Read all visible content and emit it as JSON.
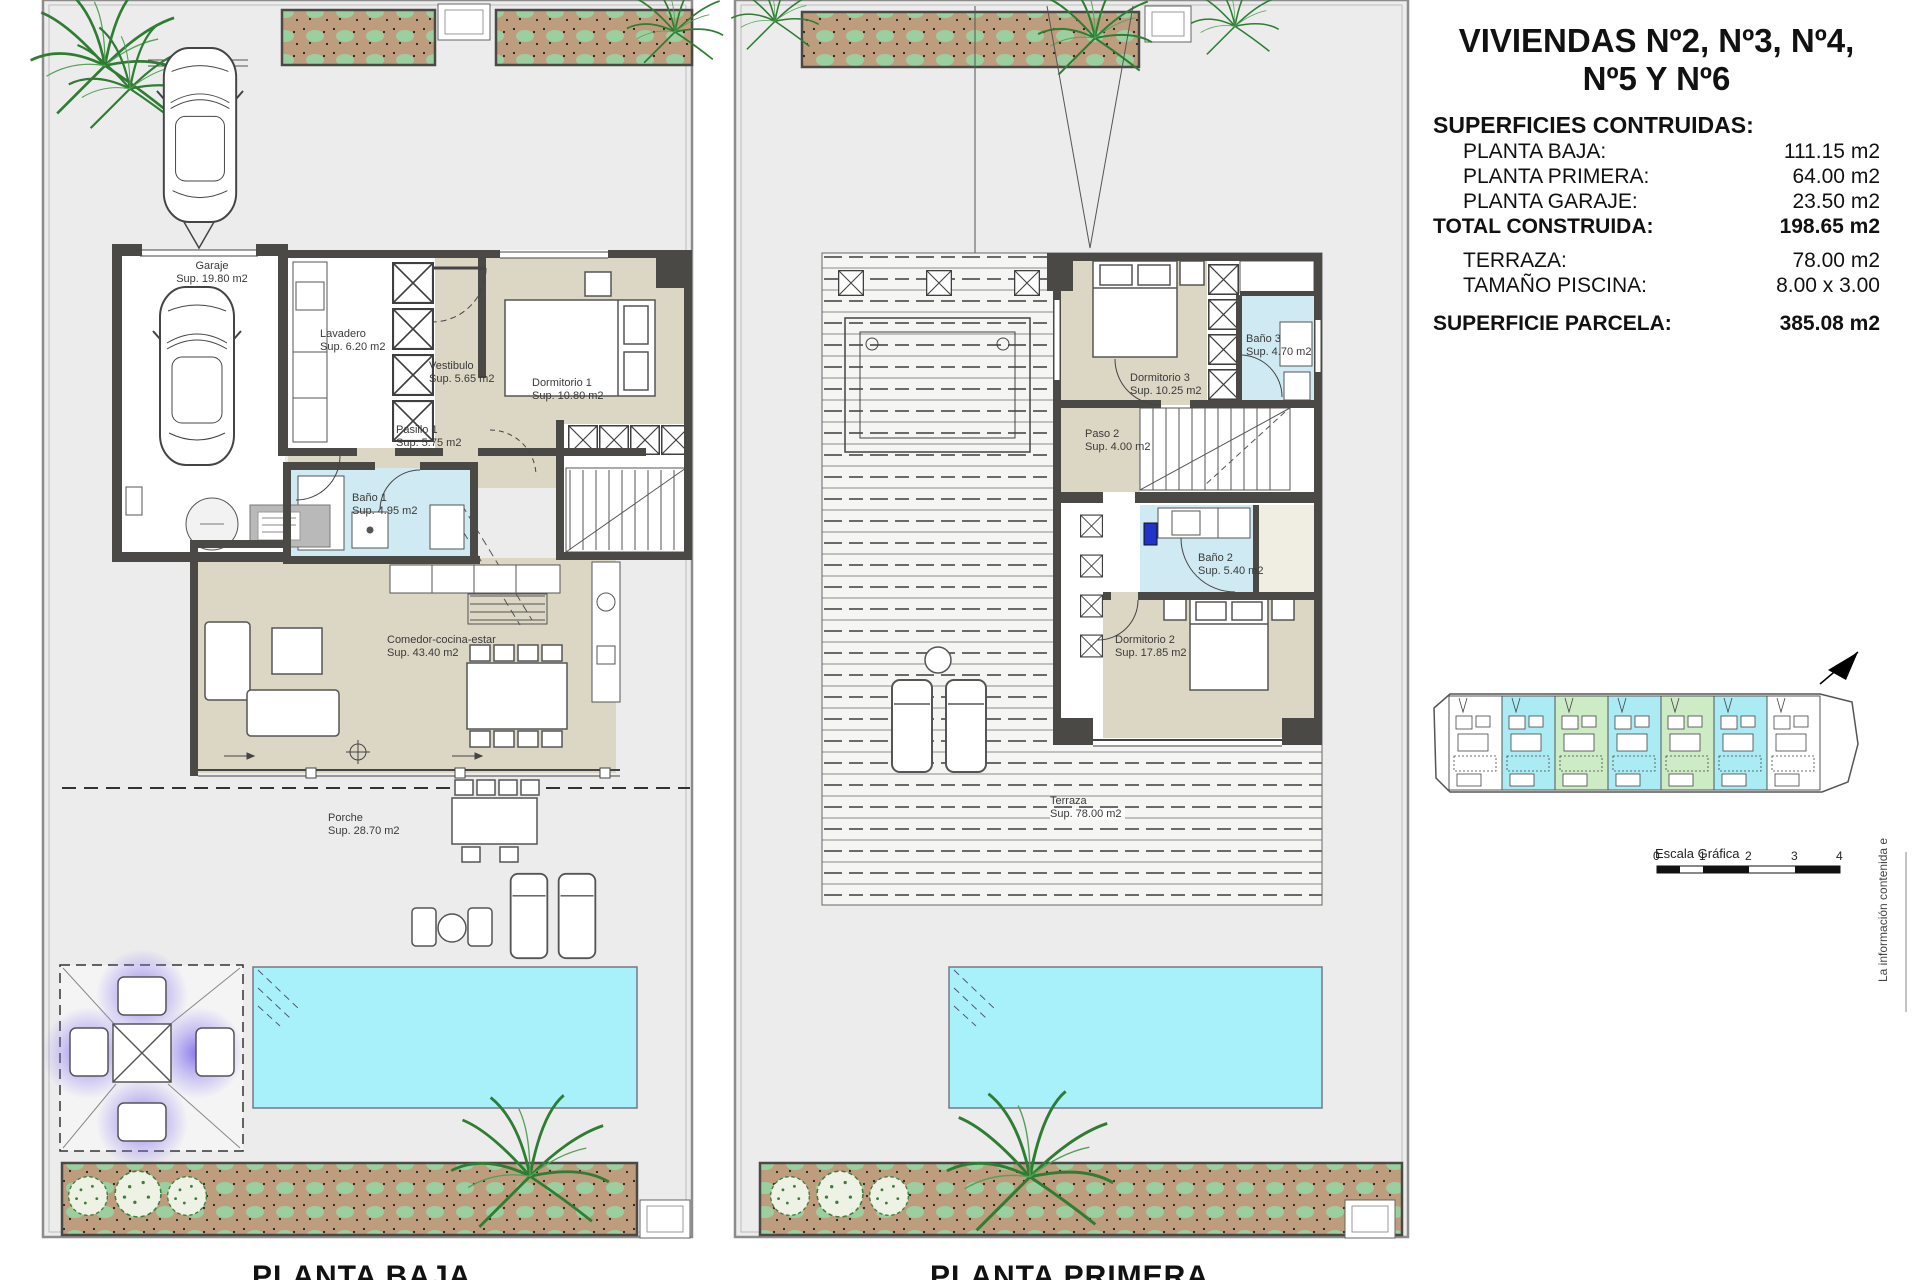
{
  "sheet": {
    "title_line1": "VIVIENDAS Nº2, Nº3, Nº4,",
    "title_line2": "Nº5 Y Nº6",
    "surfaces_heading": "SUPERFICIES CONTRUIDAS:",
    "rows": [
      {
        "label": "PLANTA BAJA:",
        "value": "111.15 m2"
      },
      {
        "label": "PLANTA PRIMERA:",
        "value": "64.00 m2"
      },
      {
        "label": "PLANTA GARAJE:",
        "value": "23.50 m2"
      },
      {
        "label": "TOTAL CONSTRUIDA:",
        "value": "198.65 m2"
      },
      {
        "label": "TERRAZA:",
        "value": "78.00 m2"
      },
      {
        "label": "TAMAÑO PISCINA:",
        "value": "8.00 x 3.00"
      },
      {
        "label": "SUPERFICIE PARCELA:",
        "value": "385.08 m2"
      }
    ],
    "scale_label": "Escala Gráfica",
    "scale_ticks": [
      "0",
      "1",
      "2",
      "3",
      "4"
    ],
    "side_note": "La información contenida e"
  },
  "plan_baja": {
    "caption": "PLANTA BAJA",
    "rooms": {
      "garaje": {
        "name": "Garaje",
        "area": "Sup. 19.80 m2"
      },
      "lavadero": {
        "name": "Lavadero",
        "area": "Sup. 6.20 m2"
      },
      "vestibulo": {
        "name": "Vestibulo",
        "area": "Sup. 5.65 m2"
      },
      "dormitorio1": {
        "name": "Dormitorio 1",
        "area": "Sup. 10.80 m2"
      },
      "pasillo1": {
        "name": "Pasillo 1",
        "area": "Sup. 5.75 m2"
      },
      "bano1": {
        "name": "Baño 1",
        "area": "Sup. 4.95 m2"
      },
      "comedor": {
        "name": "Comedor-cocina-estar",
        "area": "Sup. 43.40 m2"
      },
      "porche": {
        "name": "Porche",
        "area": "Sup. 28.70 m2"
      }
    }
  },
  "plan_primera": {
    "caption": "PLANTA PRIMERA",
    "rooms": {
      "dormitorio3": {
        "name": "Dormitorio 3",
        "area": "Sup. 10.25 m2"
      },
      "bano3": {
        "name": "Baño 3",
        "area": "Sup. 4.70 m2"
      },
      "paso2": {
        "name": "Paso 2",
        "area": "Sup. 4.00 m2"
      },
      "bano2": {
        "name": "Baño 2",
        "area": "Sup. 5.40 m2"
      },
      "dormitorio2": {
        "name": "Dormitorio 2",
        "area": "Sup. 17.85 m2"
      },
      "terraza": {
        "name": "Terraza",
        "area": "Sup. 78.00 m2"
      }
    }
  },
  "site_key": {
    "unit_colors": [
      "#ffffff",
      "#abecf4",
      "#cdebc4",
      "#abecf4",
      "#cdebc4",
      "#abecf4",
      "#ffffff"
    ]
  },
  "colors": {
    "parcel": "#ececec",
    "wall": "#4a4946",
    "floor_beige": "#dcd6c4",
    "floor_bath_blue": "#cfeaf2",
    "pool_cyan": "#a9f1fa",
    "planter_brown": "#bd9d7d",
    "planter_green": "#9ccf9f",
    "chill_purple": "#7b68e8",
    "washer_blue": "#2233cc"
  }
}
